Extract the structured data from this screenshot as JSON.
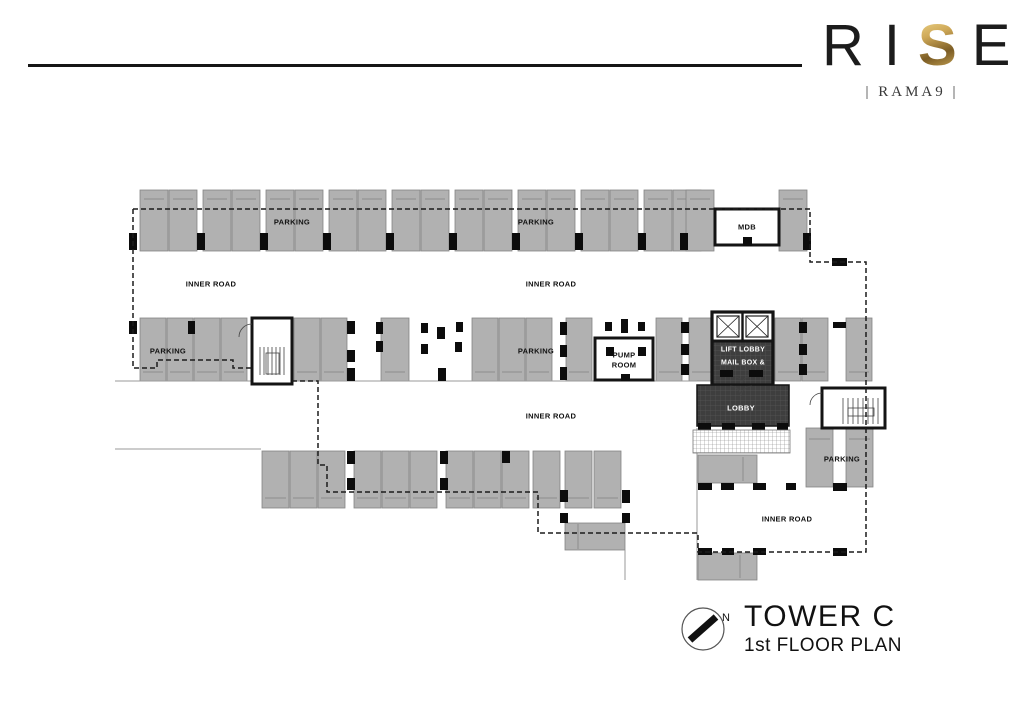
{
  "brand": {
    "letters": [
      {
        "char": "R",
        "gold": false
      },
      {
        "char": "I",
        "gold": false
      },
      {
        "char": "S",
        "gold": true
      },
      {
        "char": "E",
        "gold": false
      }
    ],
    "subtitle": "| RAMA9 |",
    "accent_gold": "#b3924a"
  },
  "plan_labels": {
    "parking_top_left": "PARKING",
    "parking_top_right": "PARKING",
    "inner_road_top_left": "INNER ROAD",
    "inner_road_top_center": "INNER ROAD",
    "parking_mid_left": "PARKING",
    "parking_mid_center": "PARKING",
    "inner_road_center": "INNER ROAD",
    "inner_road_bottom_right": "INNER ROAD",
    "parking_right": "PARKING",
    "mdb_room": "MDB",
    "pump_room_line1": "PUMP",
    "pump_room_line2": "ROOM",
    "lift_lobby_line1": "LIFT LOBBY",
    "lift_lobby_line2": "MAIL BOX &",
    "lobby": "LOBBY"
  },
  "title_block": {
    "tower": "TOWER C",
    "floor": "1st FLOOR PLAN",
    "north_label": "N"
  },
  "colors": {
    "accent_gold": "#b3924a",
    "ink": "#1a1a1a",
    "stall_fill": "#b1b1b1",
    "stall_border": "#848484",
    "lobby_dark": "#3e3e3e",
    "background": "#ffffff"
  }
}
